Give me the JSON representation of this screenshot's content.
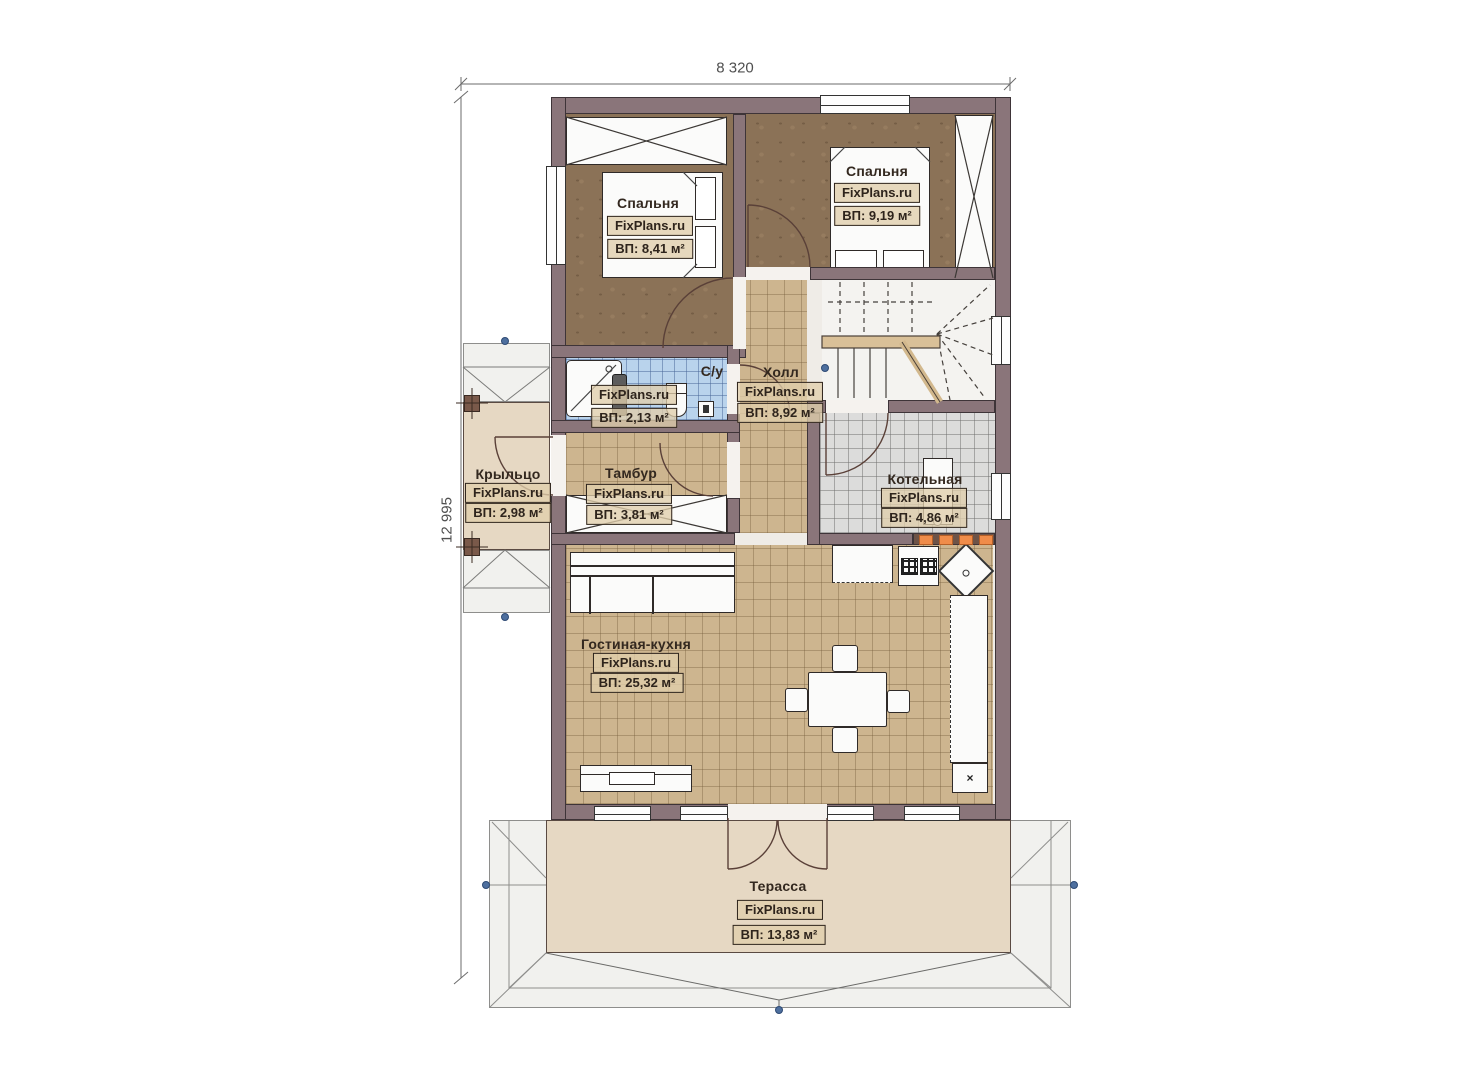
{
  "watermark": "FixPlans.ru",
  "dimensions": {
    "width": "8 320",
    "height": "12 995"
  },
  "rooms": {
    "bedroom1": {
      "name": "Спальня",
      "area": "ВП: 8,41 м²"
    },
    "bedroom2": {
      "name": "Спальня",
      "area": "ВП: 9,19 м²"
    },
    "bathroom": {
      "name": "С/у",
      "area": "ВП: 2,13 м²"
    },
    "hall": {
      "name": "Холл",
      "area": "ВП: 8,92 м²"
    },
    "porch": {
      "name": "Крыльцо",
      "area": "ВП: 2,98 м²"
    },
    "vestibule": {
      "name": "Тамбур",
      "area": "ВП: 3,81 м²"
    },
    "boiler": {
      "name": "Котельная",
      "area": "ВП: 4,86 м²"
    },
    "living": {
      "name": "Гостиная-кухня",
      "area": "ВП: 25,32 м²"
    },
    "terrace": {
      "name": "Терасса",
      "area": "ВП: 13,83 м²"
    }
  },
  "markers": {
    "close": "×"
  },
  "colors": {
    "wall": "#8a757a",
    "floor_wood": "#8b7257",
    "floor_tile": "#cdb58f",
    "tile_blue": "#b9d3ec",
    "tile_gray": "#dcdcdb",
    "deck": "#e6d8c3",
    "roof": "#f1f1ee",
    "accent_orange": "#ef8c4a",
    "marker_blue": "#4e6f9e"
  }
}
